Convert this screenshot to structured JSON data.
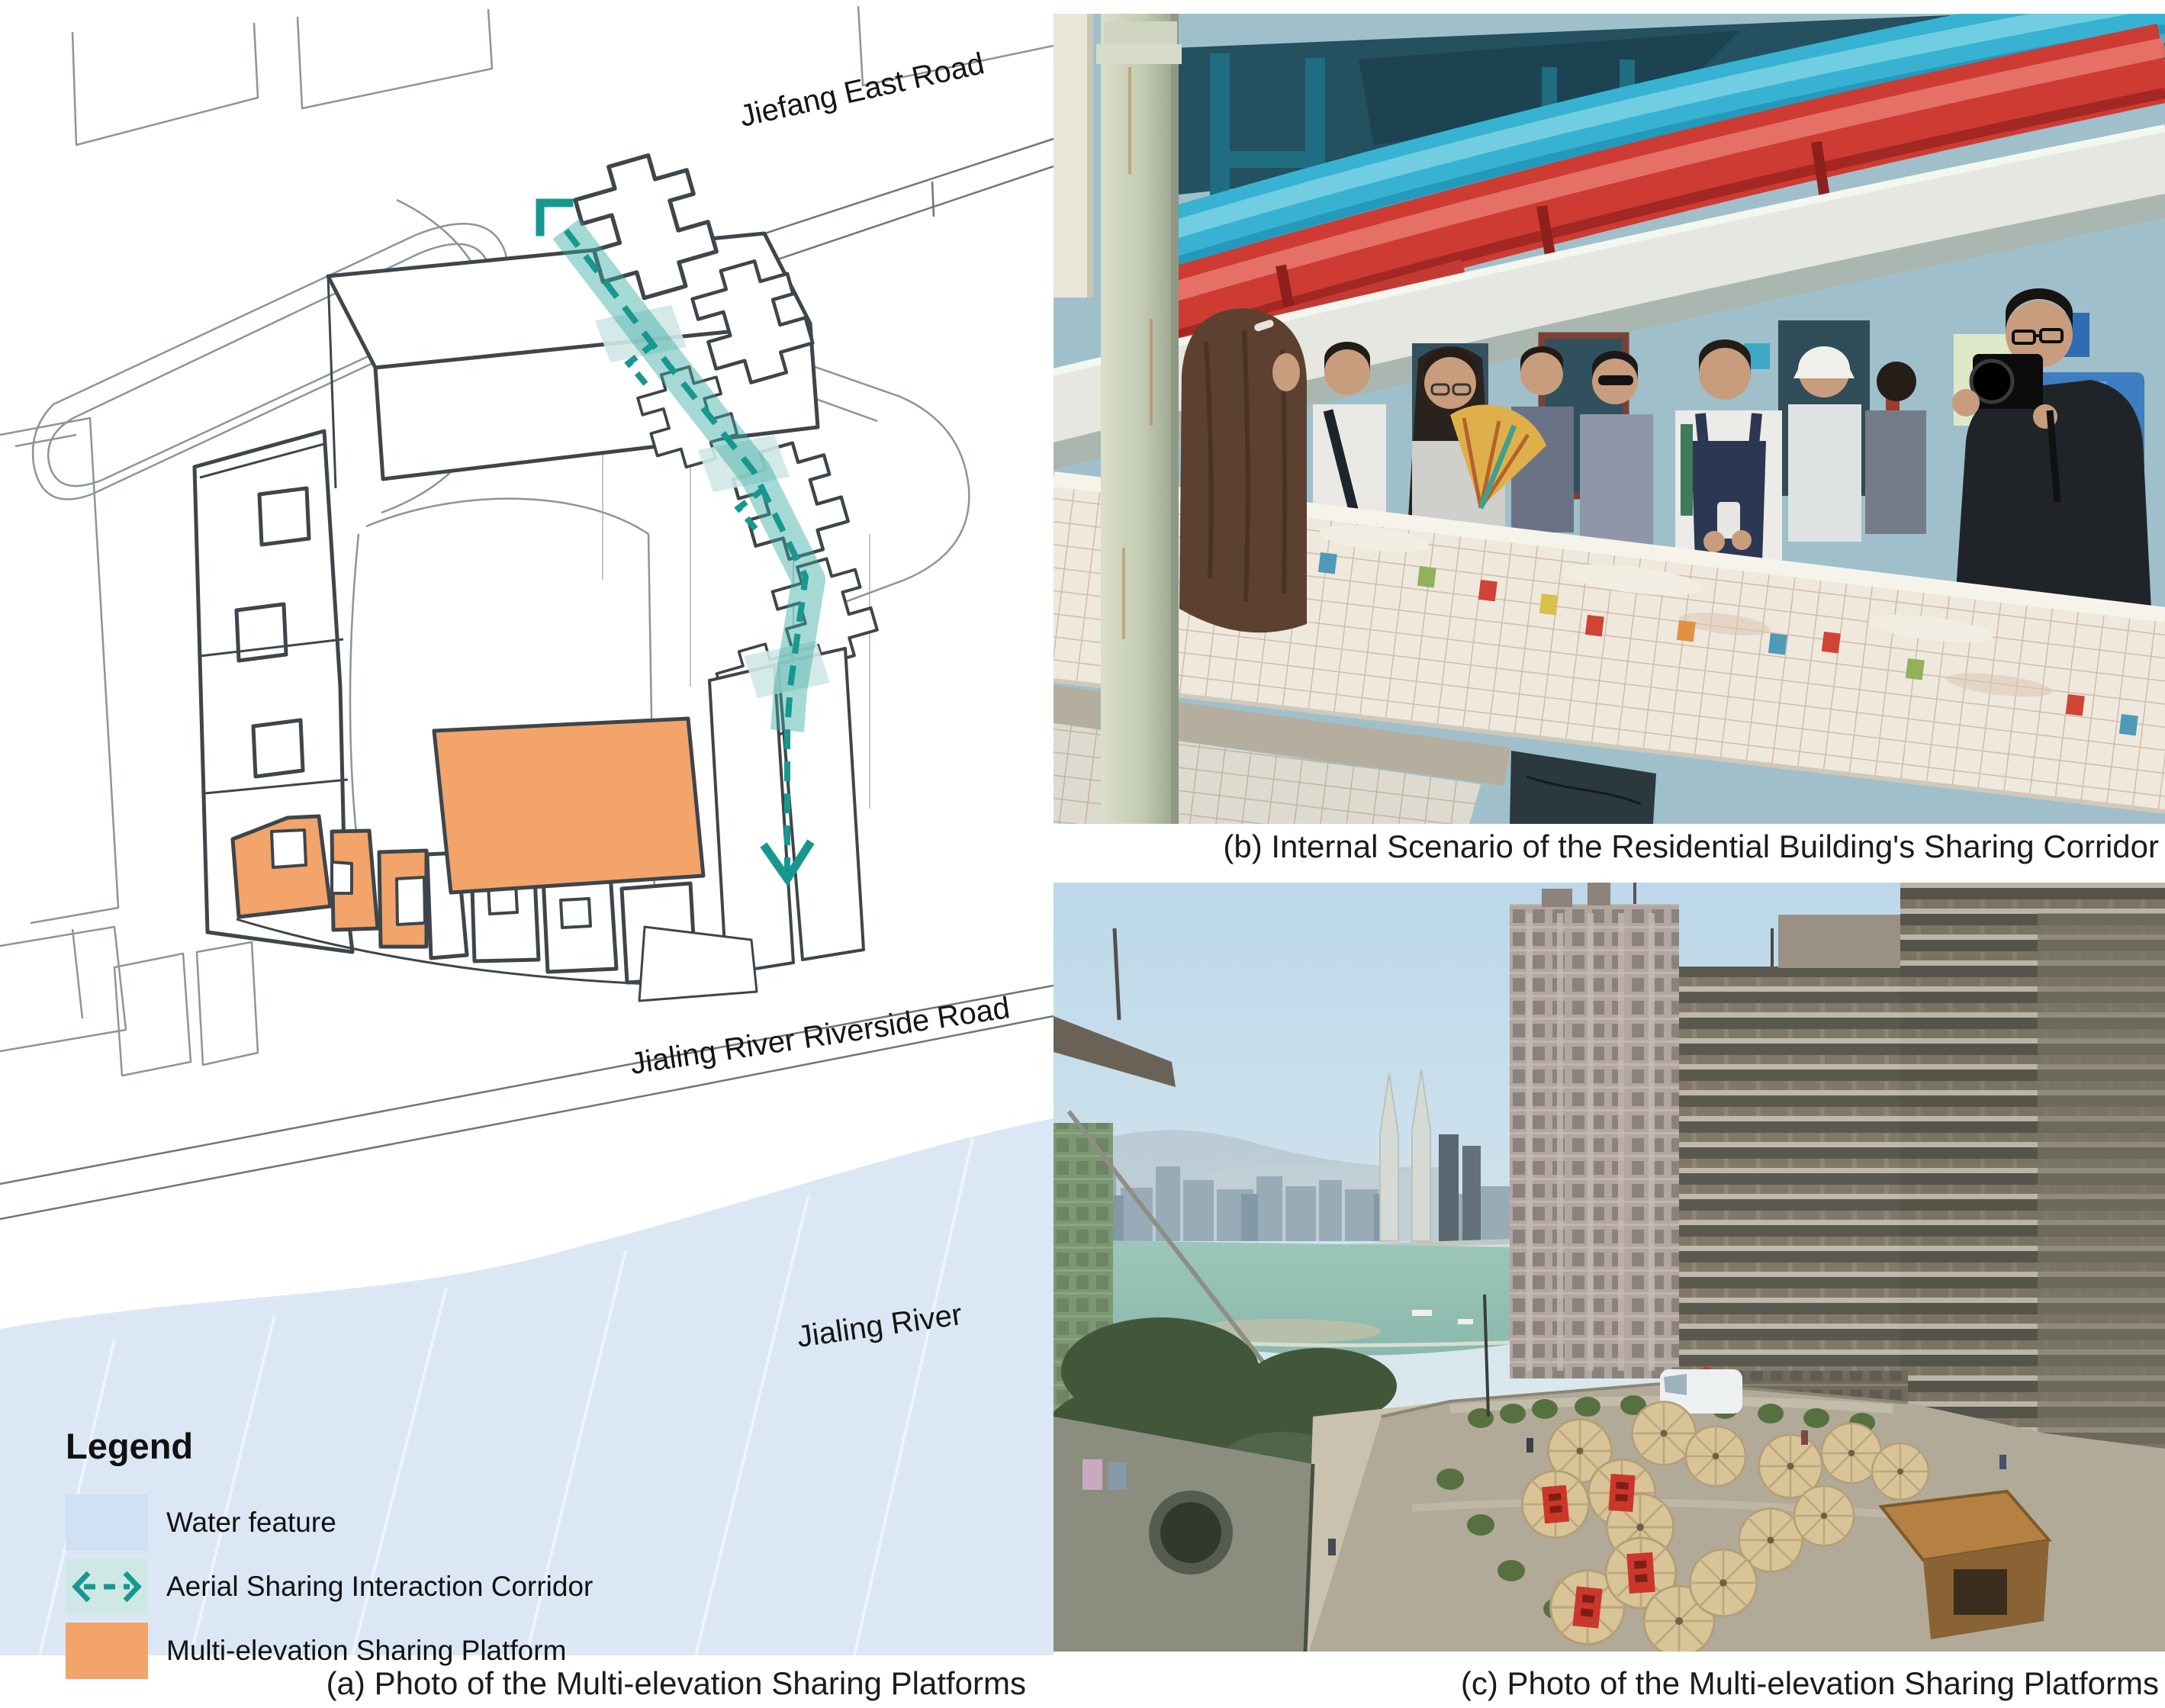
{
  "panels": {
    "a": {
      "caption": "(a) Photo of the Multi-elevation Sharing Platforms",
      "map": {
        "road_label_top": "Jiefang East Road",
        "road_label_bottom": "Jialing River Riverside Road",
        "water_label": "Jialing River",
        "legend": {
          "title": "Legend",
          "items": [
            {
              "label": "Water feature",
              "swatch": "water-swatch",
              "color": "#cfe1f3"
            },
            {
              "label": "Aerial Sharing Interaction Corridor",
              "swatch": "dashed-arrow-swatch",
              "color": "#17988f"
            },
            {
              "label": "Multi-elevation Sharing Platform",
              "swatch": "platform-swatch",
              "color": "#f2a46a"
            }
          ]
        },
        "colors": {
          "water": "#dbe7f5",
          "corridor_teal": "#17988f",
          "corridor_ribbon": "#7fc7c0",
          "platform_orange": "#f2a46a",
          "site_outline": "#3e454b",
          "context_line": "#8d949b"
        }
      }
    },
    "b": {
      "caption": "(b) Internal Scenario of the Residential Building's Sharing Corridor",
      "colors": {
        "pipe_cyan": "#37b2d2",
        "pipe_red": "#ce3b33",
        "ceiling": "#24505f",
        "wall": "#9fc0cb",
        "tiles": "#efe8dc",
        "door_blue": "#3e7dc0",
        "column": "#c8cfba"
      }
    },
    "c": {
      "caption": "(c) Photo of the Multi-elevation Sharing Platforms",
      "colors": {
        "sky": "#c3dceb",
        "river": "#8fbdb2",
        "umbrella": "#d9c498",
        "banner_red": "#cb382b",
        "kiosk": "#b58142",
        "buildings": "#8e8678",
        "trees": "#42573a"
      }
    }
  }
}
